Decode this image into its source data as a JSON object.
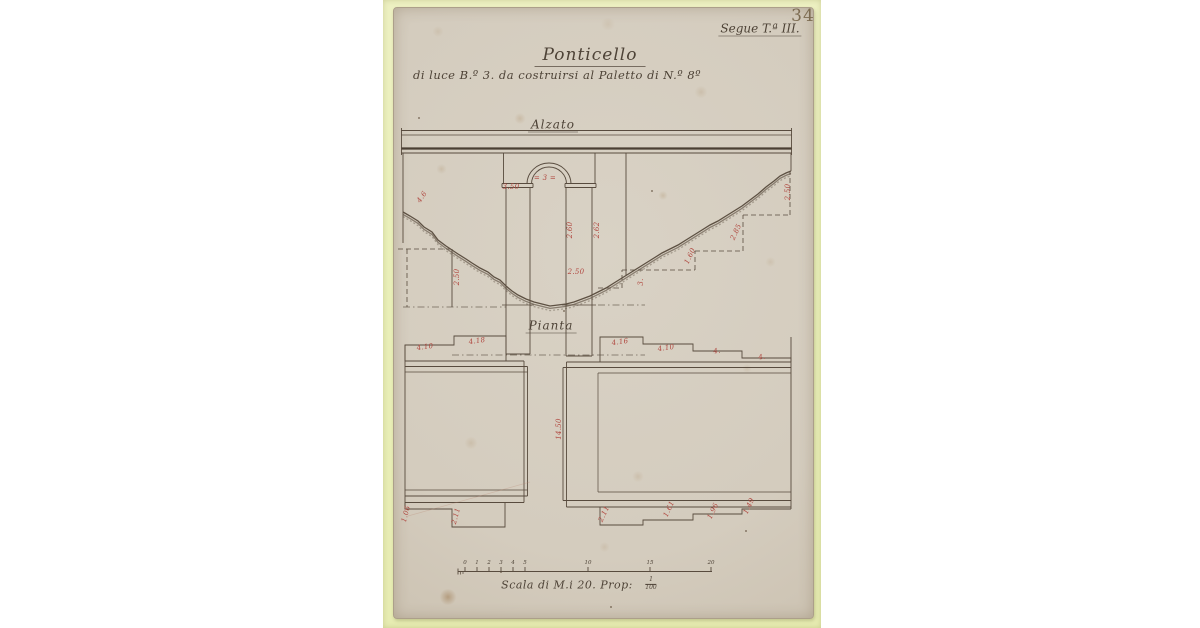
{
  "document": {
    "page_number": "34",
    "series_note": "Segue T.ª III.",
    "title": "Ponticello",
    "subtitle": "di luce B.º 3. da costruirsi al Paletto di N.º 8º"
  },
  "elevation": {
    "label": "Alzato",
    "dims": {
      "impost_left": "3.50",
      "arch_span": "= 3 =",
      "pier_right_inner": "2.60",
      "pier_right_outer": "2.62",
      "channel_width": "2.50",
      "slope_left": "4.6",
      "foundation_left": "2.50",
      "right_edge": "2.50",
      "foundation_right_upper": "2.85",
      "foundation_right_lower": "1.60",
      "foundation_right_base": "3."
    }
  },
  "plan": {
    "label": "Pianta",
    "dims": {
      "top_left_1": "4.10",
      "top_left_2": "4.18",
      "top_right_1": "4.16",
      "top_right_2": "4.10",
      "top_right_3": "4.",
      "top_right_4": "4.",
      "channel_length": "14.50",
      "bottom_left_1": "1.06",
      "bottom_left_2": "2.11",
      "bottom_right_1": "2.11",
      "bottom_right_2": "1.61",
      "bottom_right_3": "1.96",
      "bottom_right_4": "1.49"
    }
  },
  "scale_bar": {
    "caption": "Scala di M.i 20. Prop:",
    "fraction_numerator": "1",
    "fraction_denominator": "100",
    "ticks": [
      "0",
      "1",
      "2",
      "3",
      "4",
      "5",
      "10",
      "15",
      "20"
    ]
  },
  "colors": {
    "ink": "#4e4337",
    "dimension_red": "#b0463e",
    "paper": "#d6cfc2",
    "mat": "#edf0c2"
  }
}
